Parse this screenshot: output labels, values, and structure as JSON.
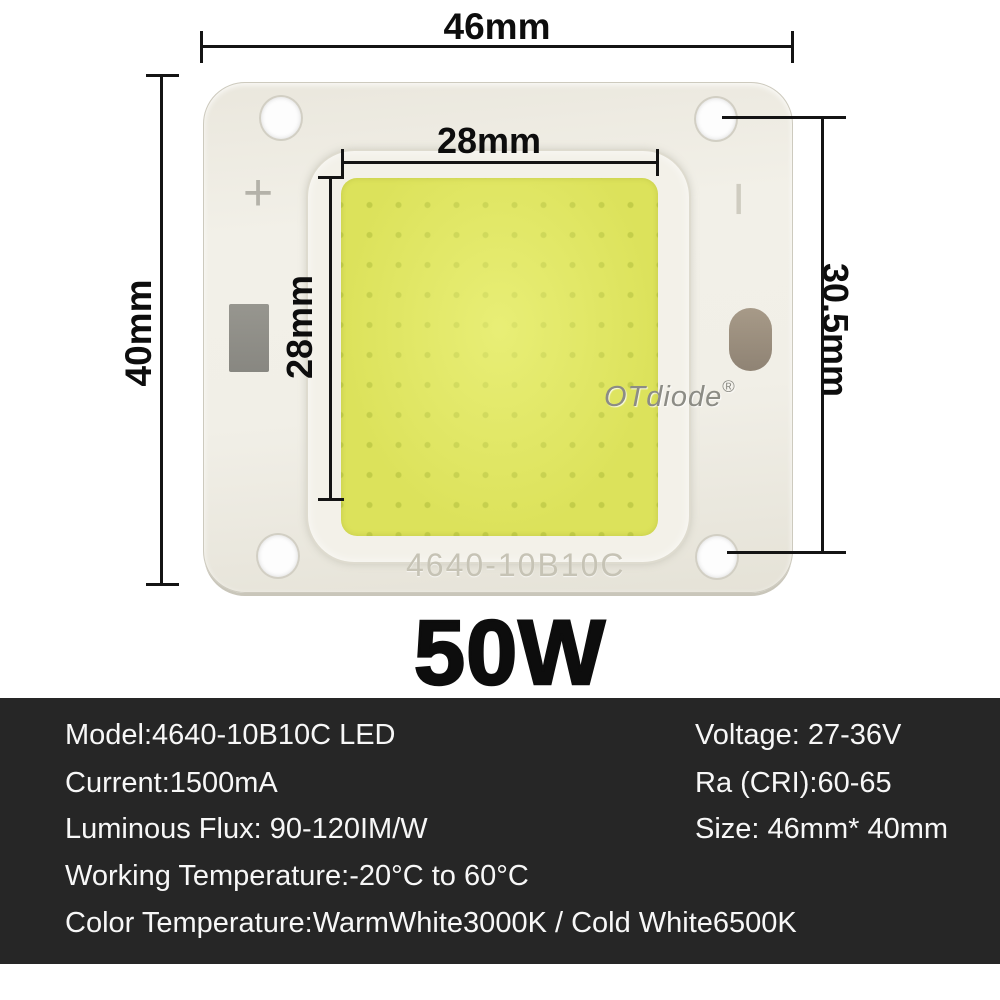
{
  "annotations": {
    "overall_width_label": "46mm",
    "overall_height_label": "40mm",
    "emitter_width_label": "28mm",
    "emitter_height_label": "28mm",
    "hole_spacing_label": "30.5mm"
  },
  "chip": {
    "brand_watermark": "OTdiode",
    "registered_symbol": "®",
    "engraved_code": "4640-10B10C",
    "positive_mark": "+",
    "negative_mark": "−"
  },
  "power_rating": "50W",
  "spec_panel": {
    "left_column": [
      "Model:4640-10B10C LED",
      "Current:1500mA",
      "Luminous Flux: 90-120IM/W",
      "Working Temperature:-20°C to 60°C",
      "Color Temperature:WarmWhite3000K / Cold White6500K"
    ],
    "right_column": [
      "Voltage: 27-36V",
      "Ra (CRI):60-65",
      "Size: 46mm* 40mm"
    ]
  },
  "colors": {
    "phosphor_yellow": "#dce25b",
    "substrate_white": "#f0eee5",
    "spec_panel_dark": "#262626",
    "annotation_black": "#141414"
  }
}
